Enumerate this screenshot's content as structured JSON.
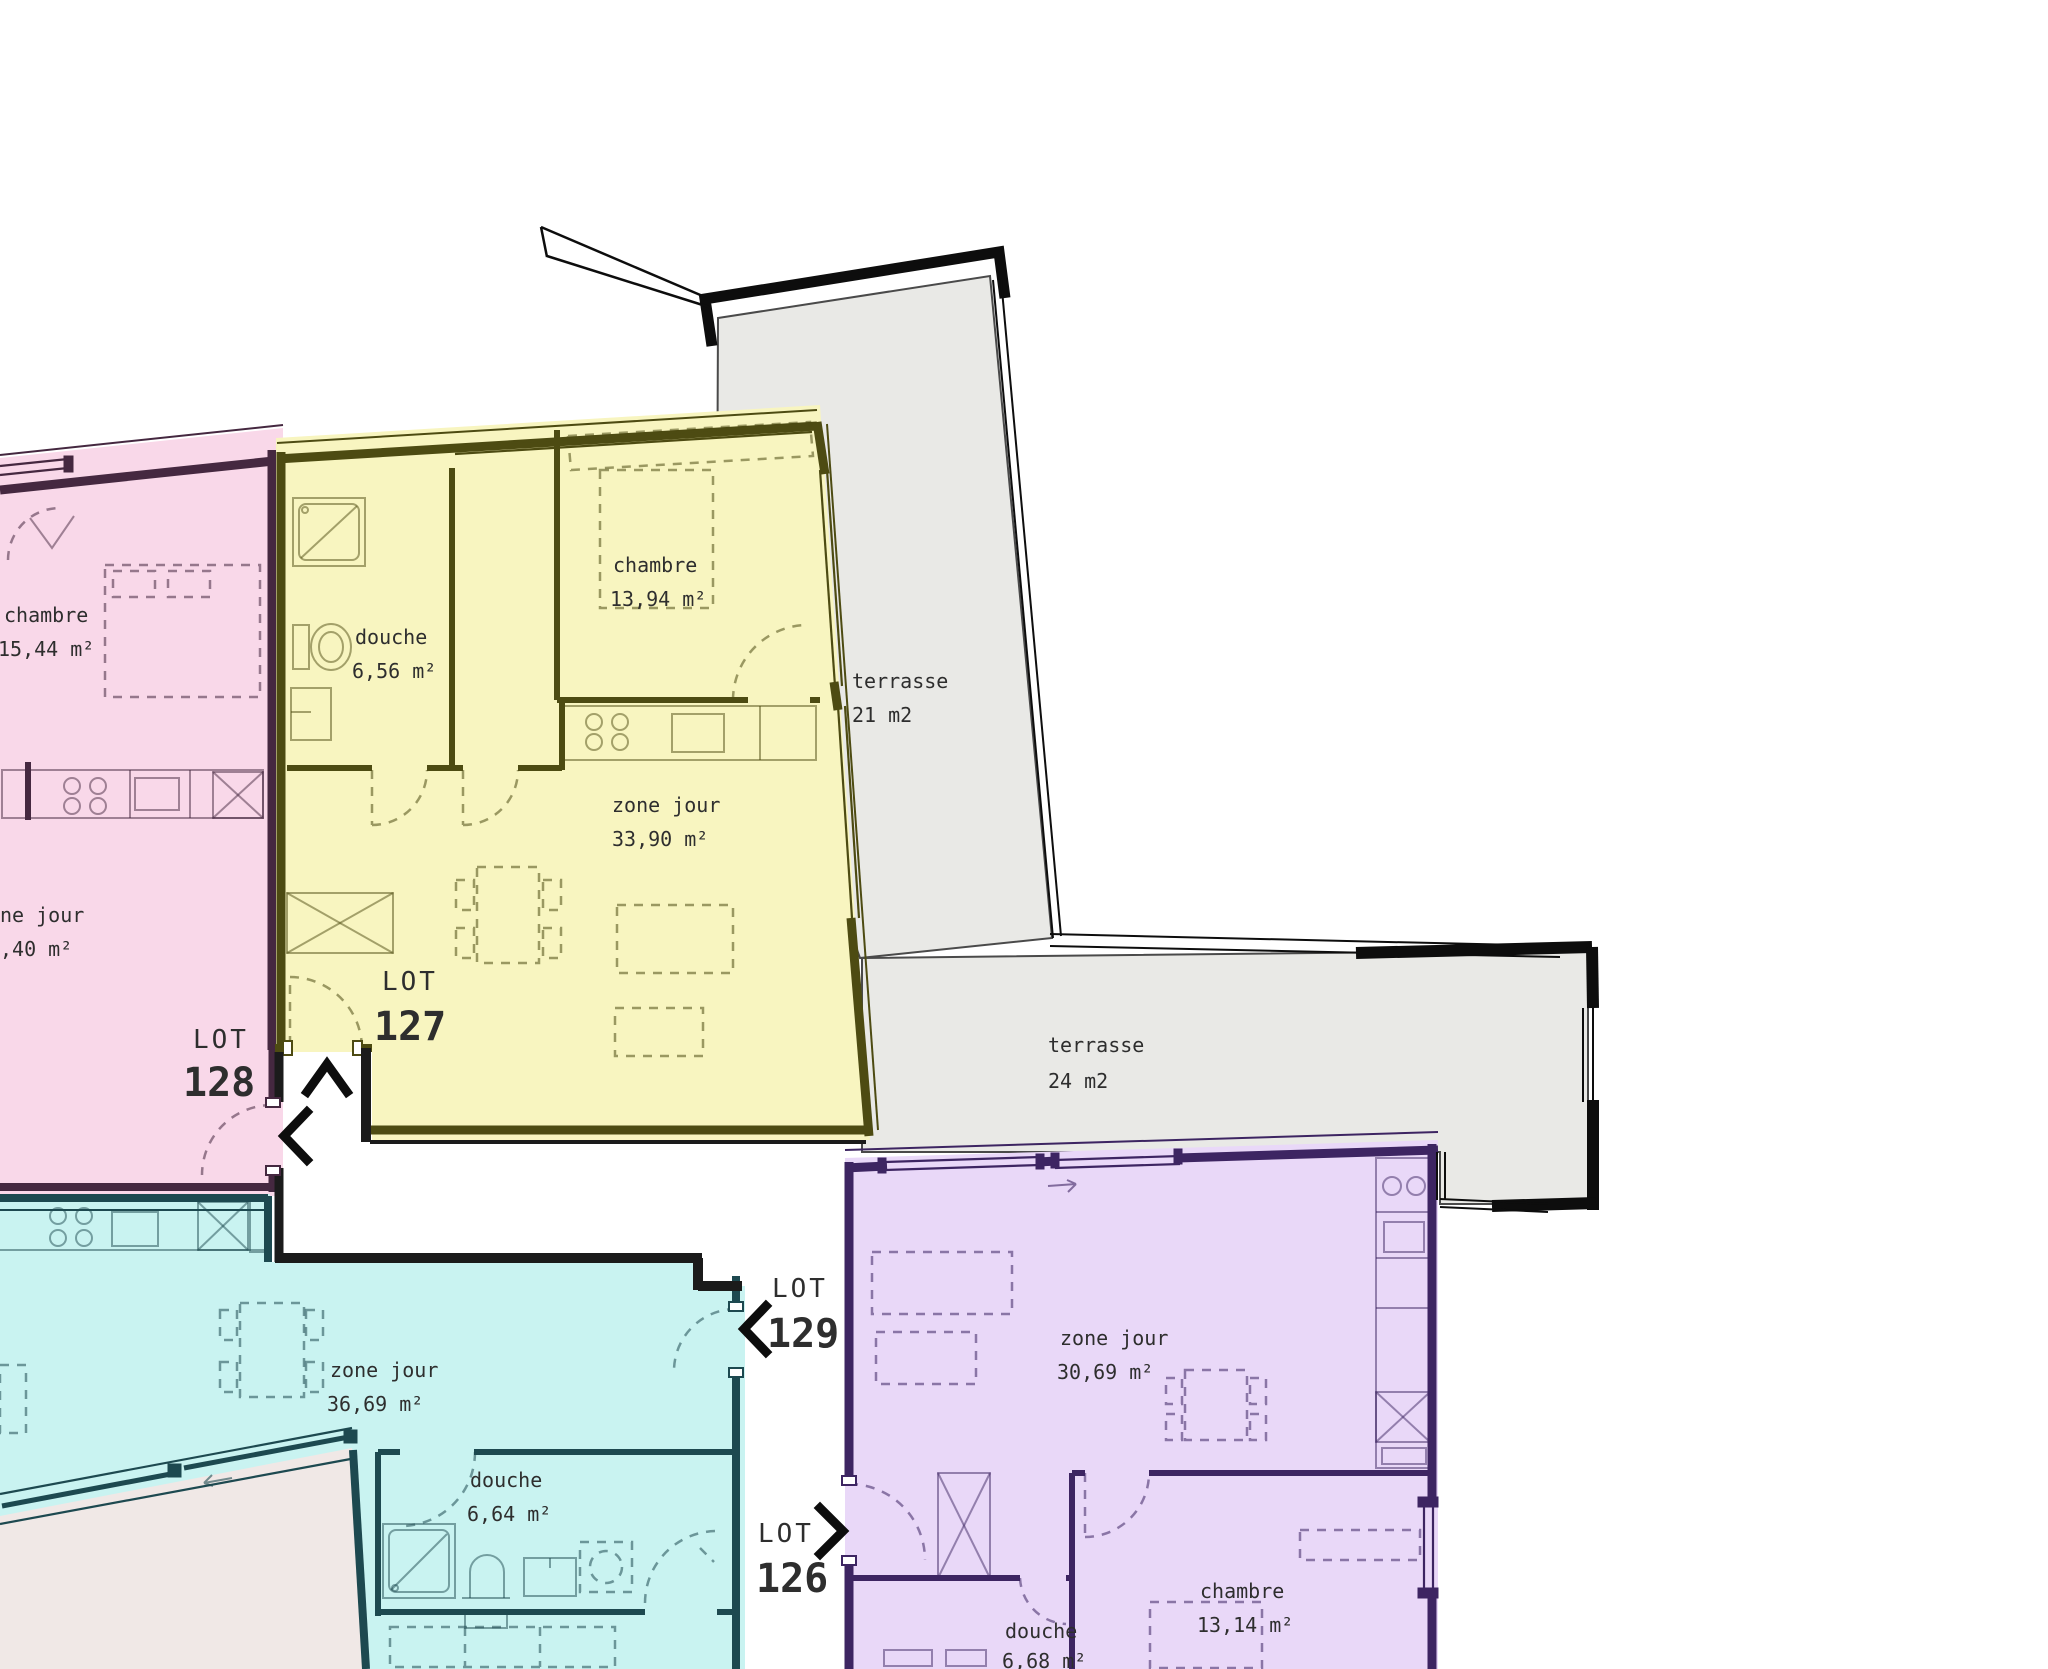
{
  "colors": {
    "pink_fill": "#f9d8e9",
    "pink_wall": "#452840",
    "yellow_fill": "#f8f5c0",
    "yellow_wall": "#4d4b12",
    "cyan_fill": "#c9f3f1",
    "cyan_wall": "#1d4950",
    "purple_fill": "#e9d8f8",
    "purple_wall": "#3d2562",
    "terrace_fill": "#e9e9e6",
    "terrace_stroke": "#4a4a4a",
    "terrace_sw_fill": "#f0e8e6",
    "railing": "#0d0d0d",
    "corridor_wall": "#1b1b1b",
    "text": "#2e2e2e"
  },
  "lots": {
    "lot126": {
      "label": "LOT",
      "number": "126"
    },
    "lot127": {
      "label": "LOT",
      "number": "127"
    },
    "lot128": {
      "label": "LOT",
      "number": "128"
    },
    "lot129": {
      "label": "LOT",
      "number": "129"
    }
  },
  "arrows": {
    "lot127_entrance": "chevron-up",
    "lot128_entrance": "chevron-left",
    "lot129_entrance": "chevron-left",
    "lot126_entrance": "chevron-right"
  },
  "rooms": {
    "pink_chambre": {
      "name": "chambre",
      "area": "15,44 m²"
    },
    "pink_zone_jour": {
      "name": "ne jour",
      "area": ",40 m²"
    },
    "yellow_douche": {
      "name": "douche",
      "area": "6,56 m²"
    },
    "yellow_chambre": {
      "name": "chambre",
      "area": "13,94 m²"
    },
    "yellow_zone_jour": {
      "name": "zone jour",
      "area": "33,90 m²"
    },
    "cyan_zone_jour": {
      "name": "zone jour",
      "area": "36,69 m²"
    },
    "cyan_douche": {
      "name": "douche",
      "area": "6,64 m²"
    },
    "purple_zone_jour": {
      "name": "zone jour",
      "area": "30,69 m²"
    },
    "purple_chambre": {
      "name": "chambre",
      "area": "13,14 m²"
    },
    "purple_douche": {
      "name": "douche",
      "area": "6,68 m²"
    }
  },
  "terraces": {
    "t21": {
      "name": "terrasse",
      "area": "21 m2"
    },
    "t24": {
      "name": "terrasse",
      "area": "24 m2"
    }
  }
}
